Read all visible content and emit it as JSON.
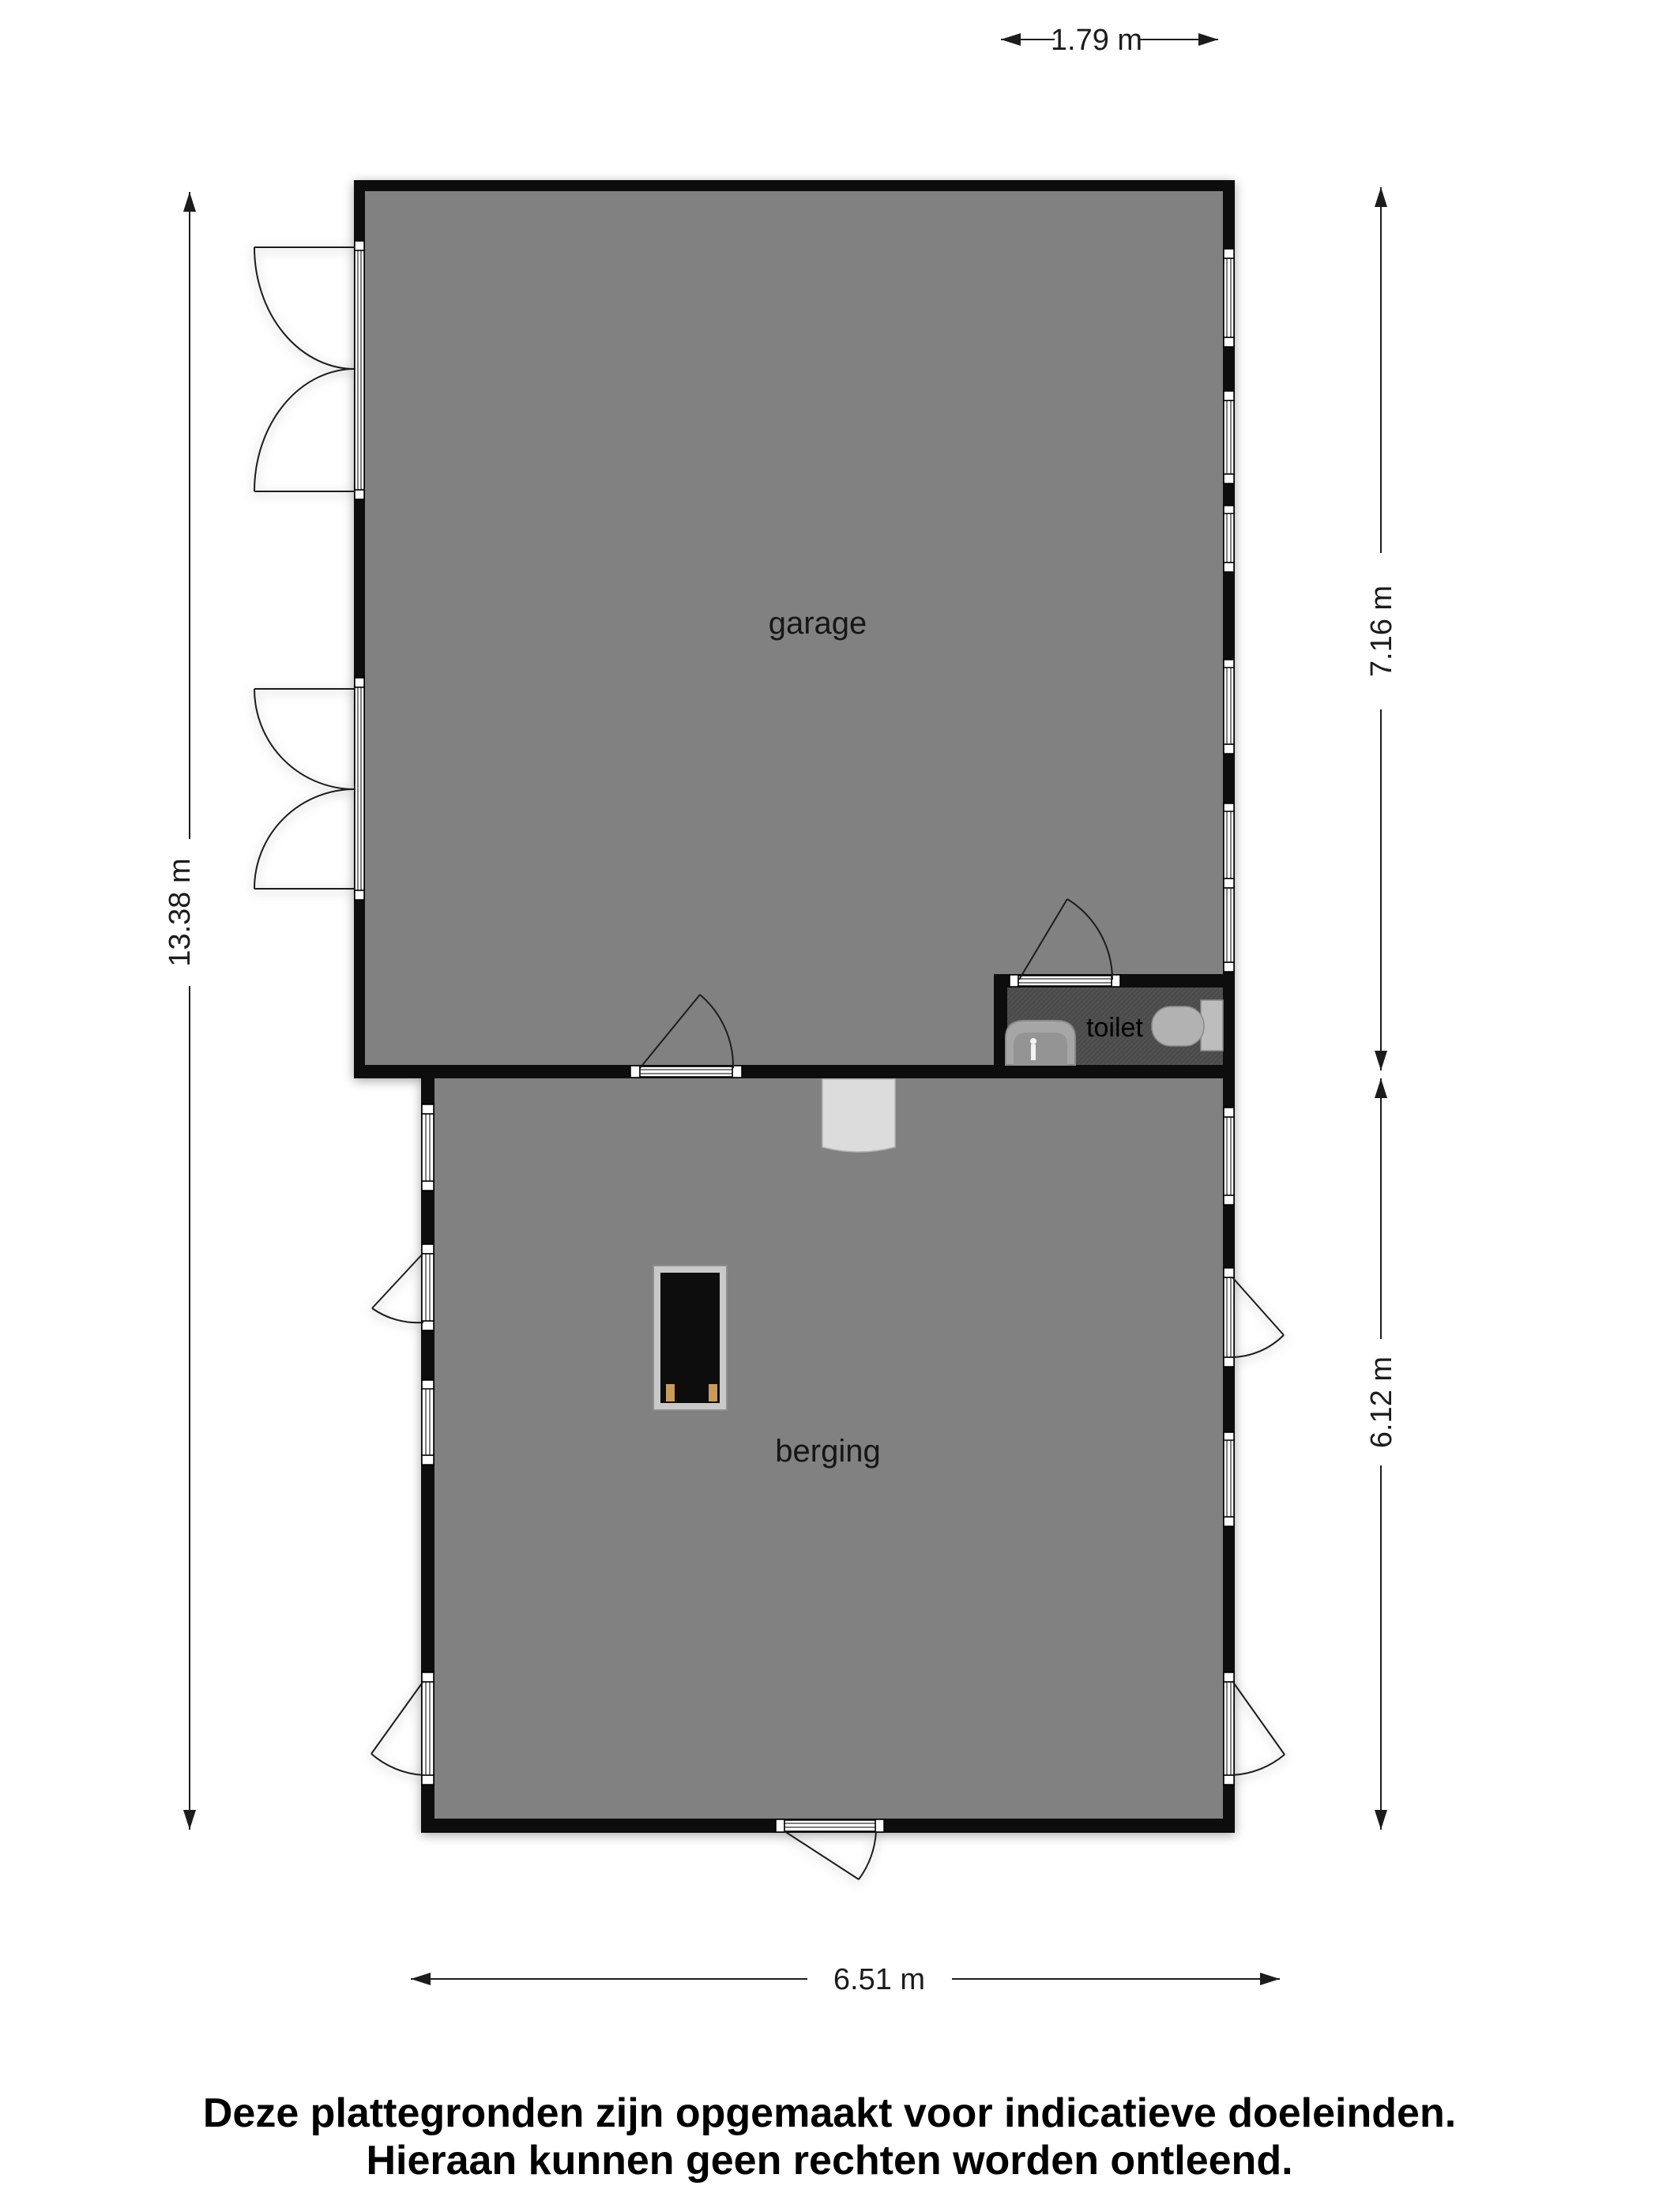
{
  "floorplan": {
    "rooms": {
      "garage": {
        "label": "garage"
      },
      "berging": {
        "label": "berging"
      },
      "toilet": {
        "label": "toilet"
      }
    },
    "dimensions": {
      "toilet_width": "1.79 m",
      "total_height": "13.38 m",
      "garage_height": "7.16 m",
      "berging_height": "6.12 m",
      "berging_width": "6.51 m"
    }
  },
  "footer": {
    "line1": "Deze plattegronden zijn opgemaakt voor indicatieve doeleinden.",
    "line2": "Hieraan kunnen geen rechten worden ontleend."
  },
  "colors": {
    "room_fill": "#818181",
    "toilet_floor": "#4c4c4c",
    "wall": "#0a0a0a",
    "doormat": "#dcdcdc",
    "stove_frame": "#c9c9c9",
    "stove_body": "#0d0d0d",
    "stove_feet": "#c89b5c",
    "fixture": "#b2b2b2"
  }
}
